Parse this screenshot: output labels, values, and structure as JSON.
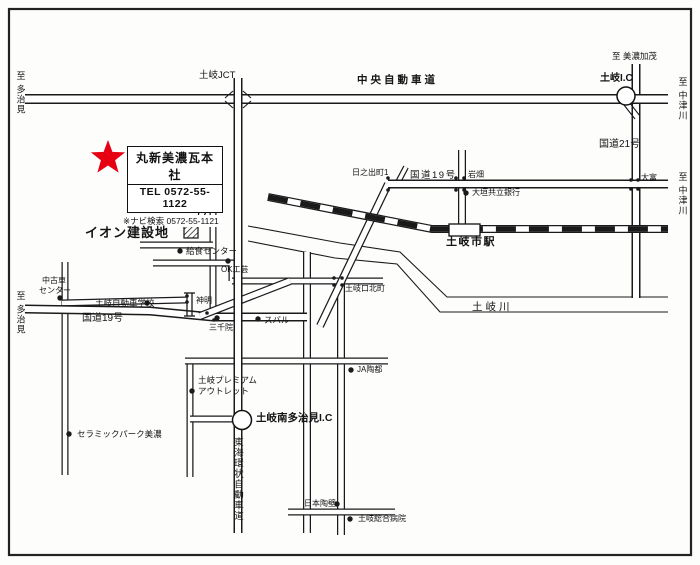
{
  "colors": {
    "ink": "#1a1a1a",
    "star_red": "#e60012",
    "bg": "#fdfdfc"
  },
  "callout": {
    "company": "丸新美濃瓦本社",
    "tel": "TEL 0572-55-1122",
    "navi_note": "※ナビ検索 0572-55-1121"
  },
  "map": {
    "labels": [
      {
        "id": "to-tajimi-top",
        "text": "至 多治見",
        "x": 15,
        "y": 71,
        "s": 9,
        "v": 1
      },
      {
        "id": "toki-jct",
        "text": "土岐JCT",
        "x": 199,
        "y": 71,
        "s": 9.5
      },
      {
        "id": "chuo-expressway",
        "text": "中央自動車道",
        "x": 357,
        "y": 75,
        "s": 10.5,
        "b": 1,
        "ls": 3
      },
      {
        "id": "to-minokamo",
        "text": "至 美濃加茂",
        "x": 612,
        "y": 52,
        "s": 8.5
      },
      {
        "id": "toki-ic",
        "text": "土岐I.C",
        "x": 600,
        "y": 74,
        "s": 10,
        "b": 1
      },
      {
        "id": "to-nakatsugawa-top",
        "text": "至 中津川",
        "x": 677,
        "y": 77,
        "s": 9,
        "v": 1
      },
      {
        "id": "route21",
        "text": "国道21号",
        "x": 599,
        "y": 140,
        "s": 10
      },
      {
        "id": "hinodecho",
        "text": "日之出町1",
        "x": 352,
        "y": 169,
        "s": 8
      },
      {
        "id": "route19-east",
        "text": "国道19号",
        "x": 410,
        "y": 171,
        "s": 9.5,
        "ls": 1.5
      },
      {
        "id": "iwahata",
        "text": "岩畑",
        "x": 468,
        "y": 171,
        "s": 8
      },
      {
        "id": "ogaki-kyoritsu-bank",
        "text": "大垣共立銀行",
        "x": 472,
        "y": 189,
        "s": 8,
        "dot": [
          466,
          193
        ]
      },
      {
        "id": "otomi",
        "text": "大富",
        "x": 641,
        "y": 174,
        "s": 8
      },
      {
        "id": "to-nakatsugawa-r19",
        "text": "至 中津川",
        "x": 677,
        "y": 172,
        "s": 9,
        "v": 1
      },
      {
        "id": "toki-city-station",
        "text": "土岐市駅",
        "x": 446,
        "y": 237,
        "s": 11,
        "b": 1,
        "ls": 1.5
      },
      {
        "id": "aeon-site",
        "text": "イオン建設地",
        "x": 85,
        "y": 226,
        "s": 13,
        "b": 1,
        "ls": 1
      },
      {
        "id": "kyushoku-center",
        "text": "給食センター",
        "x": 186,
        "y": 247,
        "s": 8.5,
        "dot": [
          180,
          251
        ]
      },
      {
        "id": "ok-kogei",
        "text": "OK工芸",
        "x": 221,
        "y": 266,
        "s": 8,
        "dot": [
          228,
          261
        ]
      },
      {
        "id": "used-car-center-1",
        "text": "中古車",
        "x": 42,
        "y": 277,
        "s": 8
      },
      {
        "id": "used-car-center-2",
        "text": "センター",
        "x": 39,
        "y": 287,
        "s": 8,
        "dot": [
          60,
          298
        ]
      },
      {
        "id": "to-tajimi-left",
        "text": "至 多治見",
        "x": 15,
        "y": 291,
        "s": 9,
        "v": 1
      },
      {
        "id": "toki-driving-school",
        "text": "土岐自動車学校",
        "x": 95,
        "y": 299,
        "s": 8.5,
        "dot": [
          147,
          303
        ]
      },
      {
        "id": "route19-west",
        "text": "国道19号",
        "x": 82,
        "y": 314,
        "s": 10
      },
      {
        "id": "shinmei",
        "text": "神明",
        "x": 196,
        "y": 297,
        "s": 8
      },
      {
        "id": "sanzenin",
        "text": "三千院",
        "x": 209,
        "y": 324,
        "s": 8,
        "dot": [
          217,
          318
        ]
      },
      {
        "id": "subaru",
        "text": "スバル",
        "x": 264,
        "y": 316,
        "s": 8.5,
        "dot": [
          258,
          319
        ]
      },
      {
        "id": "tokiguchi-kitamachi",
        "text": "土岐口北町",
        "x": 345,
        "y": 285,
        "s": 8
      },
      {
        "id": "toki-river",
        "text": "土岐川",
        "x": 472,
        "y": 302,
        "s": 10.5,
        "ls": 3
      },
      {
        "id": "ja-toto",
        "text": "JA陶都",
        "x": 357,
        "y": 366,
        "s": 8,
        "dot": [
          351,
          370
        ]
      },
      {
        "id": "toki-premium-outlet-1",
        "text": "土岐プレミアム",
        "x": 198,
        "y": 376,
        "s": 8.5
      },
      {
        "id": "toki-premium-outlet-2",
        "text": "アウトレット",
        "x": 198,
        "y": 387,
        "s": 8.5,
        "dot": [
          192,
          391
        ]
      },
      {
        "id": "toki-minami-tajimi-ic",
        "text": "土岐南多治見I.C",
        "x": 256,
        "y": 413,
        "s": 10.5,
        "b": 1
      },
      {
        "id": "ceramic-park-mino",
        "text": "セラミックパーク美濃",
        "x": 77,
        "y": 430,
        "s": 8.5,
        "dot": [
          69,
          434
        ]
      },
      {
        "id": "tokai-kanjo-expressway",
        "text": "東海環状自動車道",
        "x": 232,
        "y": 437,
        "s": 9.5,
        "v": 1
      },
      {
        "id": "nihon-toheki",
        "text": "日本陶壁",
        "x": 304,
        "y": 500,
        "s": 8,
        "dot": [
          337,
          504
        ]
      },
      {
        "id": "toki-general-hospital",
        "text": "土岐総合病院",
        "x": 358,
        "y": 515,
        "s": 8,
        "dot": [
          350,
          519
        ]
      }
    ],
    "junction_dots": [
      [
        388,
        178
      ],
      [
        388,
        190
      ],
      [
        456,
        178
      ],
      [
        464,
        178
      ],
      [
        456,
        190
      ],
      [
        464,
        190
      ],
      [
        631,
        180
      ],
      [
        638,
        180
      ],
      [
        631,
        189
      ],
      [
        638,
        189
      ],
      [
        334,
        278
      ],
      [
        342,
        278
      ],
      [
        334,
        285
      ],
      [
        342,
        285
      ],
      [
        187,
        296
      ],
      [
        187,
        302
      ],
      [
        207,
        313
      ],
      [
        214,
        320
      ]
    ]
  }
}
